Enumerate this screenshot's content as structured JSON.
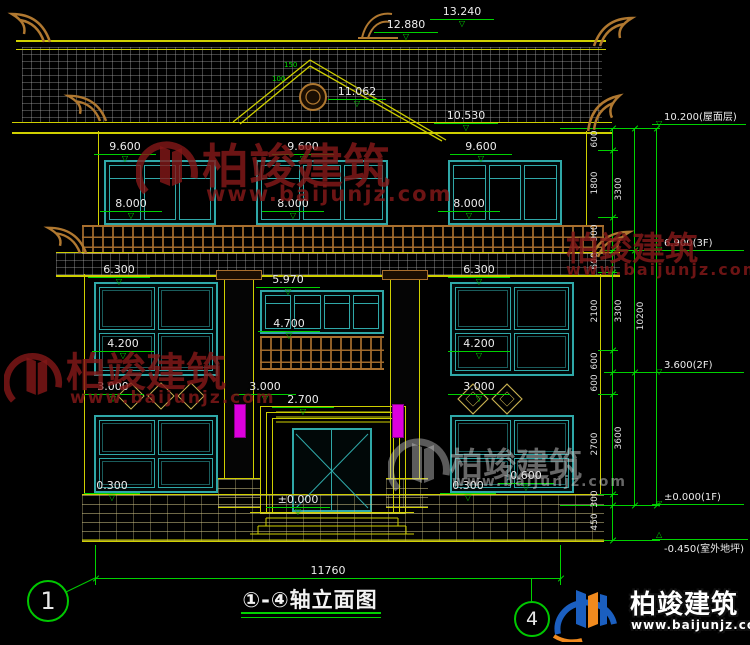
{
  "drawing": {
    "title": "①-④轴立面图",
    "axis_left": "1",
    "axis_right": "4",
    "overall_width": "11760"
  },
  "dims": {
    "v13240": "13.240",
    "v12880": "12.880",
    "v11062": "11.062",
    "v10530": "10.530",
    "v9600": "9.600",
    "v8000": "8.000",
    "v6300": "6.300",
    "v5970": "5.970",
    "v4700": "4.700",
    "v4200": "4.200",
    "v3000": "3.000",
    "v2700": "2.700",
    "v0300": "0.300",
    "v0600": "0.600",
    "vzero": "±0.000",
    "g150": "150",
    "g100": "100"
  },
  "right_chain": {
    "segments": [
      "600",
      "1800",
      "900",
      "600",
      "2100",
      "600",
      "600",
      "2700",
      "300",
      "450"
    ],
    "subtotals": [
      "3300",
      "3300",
      "3600"
    ],
    "overall": "10200",
    "levels": {
      "roof": "10.200(屋面层)",
      "f3": "6.900(3F)",
      "f2": "3.600(2F)",
      "f1": "±0.000(1F)",
      "ground": "-0.450(室外地坪)"
    }
  },
  "icons": {
    "level_down": "▽",
    "level_up": "△"
  },
  "watermark": {
    "brand": "柏竣建筑",
    "url": "www.baijunjz.com"
  },
  "logo": {
    "brand": "柏竣建筑",
    "url": "www.baijunjz.com"
  },
  "colors": {
    "dim_green": "#00d200",
    "outline_yellow": "#cfcf00",
    "window_teal": "#2fa8a8",
    "wood_brown": "#a86f2e",
    "magenta": "#dd00dd",
    "watermark_red": "#841818",
    "logo_blue": "#1b5fc0",
    "logo_orange": "#f08a1e"
  }
}
